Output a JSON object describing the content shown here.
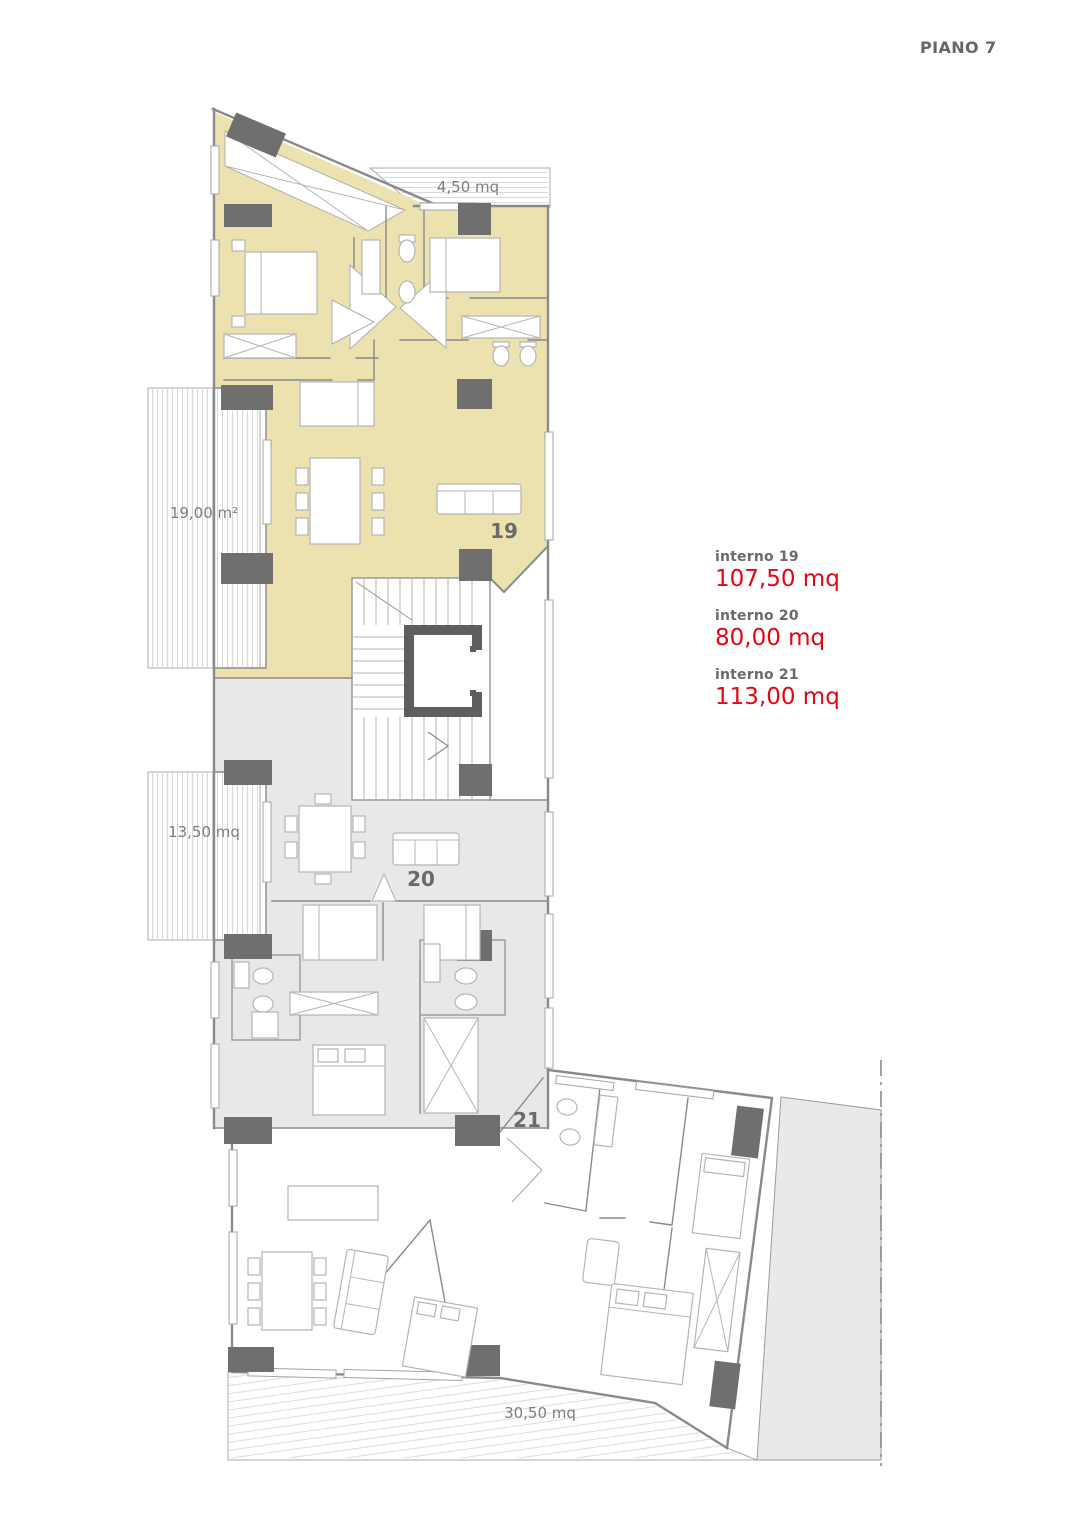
{
  "page": {
    "title": "PIANO 7"
  },
  "legend": {
    "items": [
      {
        "label": "interno 19",
        "value": "107,50 mq"
      },
      {
        "label": "interno 20",
        "value": "80,00 mq"
      },
      {
        "label": "interno 21",
        "value": "113,00 mq"
      }
    ]
  },
  "plan": {
    "apartment_numbers": {
      "a19": "19",
      "a20": "20",
      "a21": "21"
    },
    "area_labels": {
      "balcony_top": "4,50 mq",
      "terrace_19": "19,00 m²",
      "terrace_20": "13,50 mq",
      "terrace_21": "30,50 mq"
    }
  },
  "colors": {
    "apartment19_fill": "#ECE2B0",
    "apartment20_fill": "#E8E8E8",
    "adjacent_area_fill": "#E9E9E9",
    "pillar": "#6F6F6F",
    "elevator_wall": "#5E5E5E",
    "wall": "#8A8A8A",
    "furniture": "#B5B5B5",
    "label_text": "#6A6A6A",
    "label_muted": "#7D7D7D",
    "area_value": "#E30613",
    "hatch": "#C9C9C9",
    "window_stroke": "#A5A5A5"
  }
}
